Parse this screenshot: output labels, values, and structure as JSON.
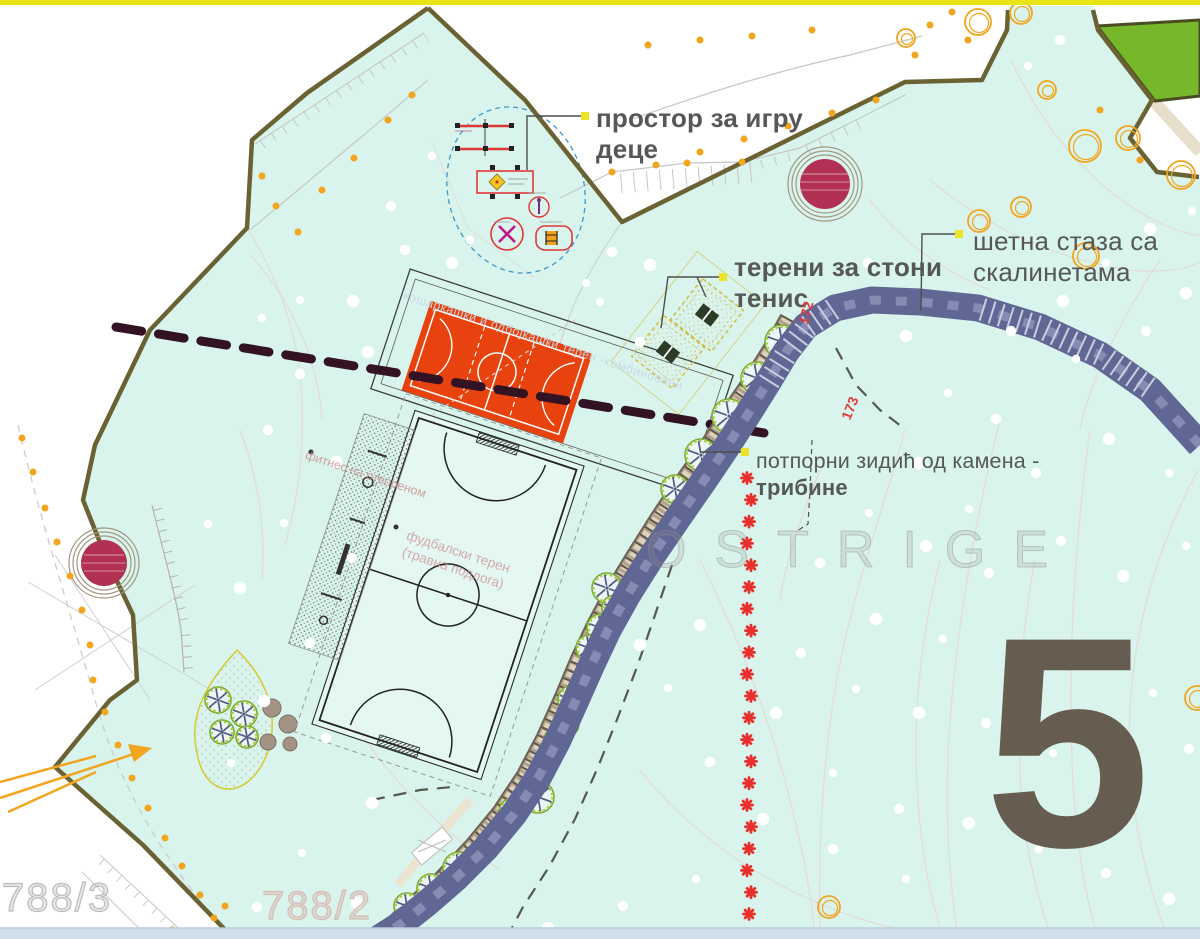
{
  "sheet_number": "5",
  "watermark": "OSTRIGE",
  "parcels": {
    "p1": "788/3",
    "p2": "788/2"
  },
  "elevations": [
    "172",
    "173"
  ],
  "annotations": {
    "playground": {
      "line1": "простор за игру",
      "line2": "деце"
    },
    "table_tennis": {
      "line1": "терени за стони",
      "line2": "тенис"
    },
    "walkway": {
      "line1": "шетна стаза са",
      "line2": "скалинетама"
    },
    "retaining_wall": {
      "line1": "потпорни зидић од камена -",
      "line2": "трибине"
    },
    "football": {
      "line1": "фуд балски терен",
      "line2": "(травна подлога)"
    },
    "football_fixed": {
      "line1": "фудбалски терен",
      "line2": "(травна подлога)"
    },
    "basketball": "кошаркашки и одбојкашки терен -комбиновани",
    "fitness": "фитнес на отвореном"
  },
  "colors": {
    "park_fill": "#d8f4ec",
    "boundary_olive": "#6a6233",
    "path_blue": "#616795",
    "court_orange": "#e8420e",
    "forest_green": "#76b82a",
    "marker_yellow": "#ece428",
    "label_gray": "#565758",
    "red_marker": "#e7302e",
    "crimson_circle": "#b23152",
    "tree_orange": "#f2a51f",
    "wall_brown": "#8a7c68",
    "tree_green": "#a8cf3e",
    "sheet_gray": "#665c50",
    "top_bar_yellow": "#e9e416",
    "section_line": "#331323"
  }
}
